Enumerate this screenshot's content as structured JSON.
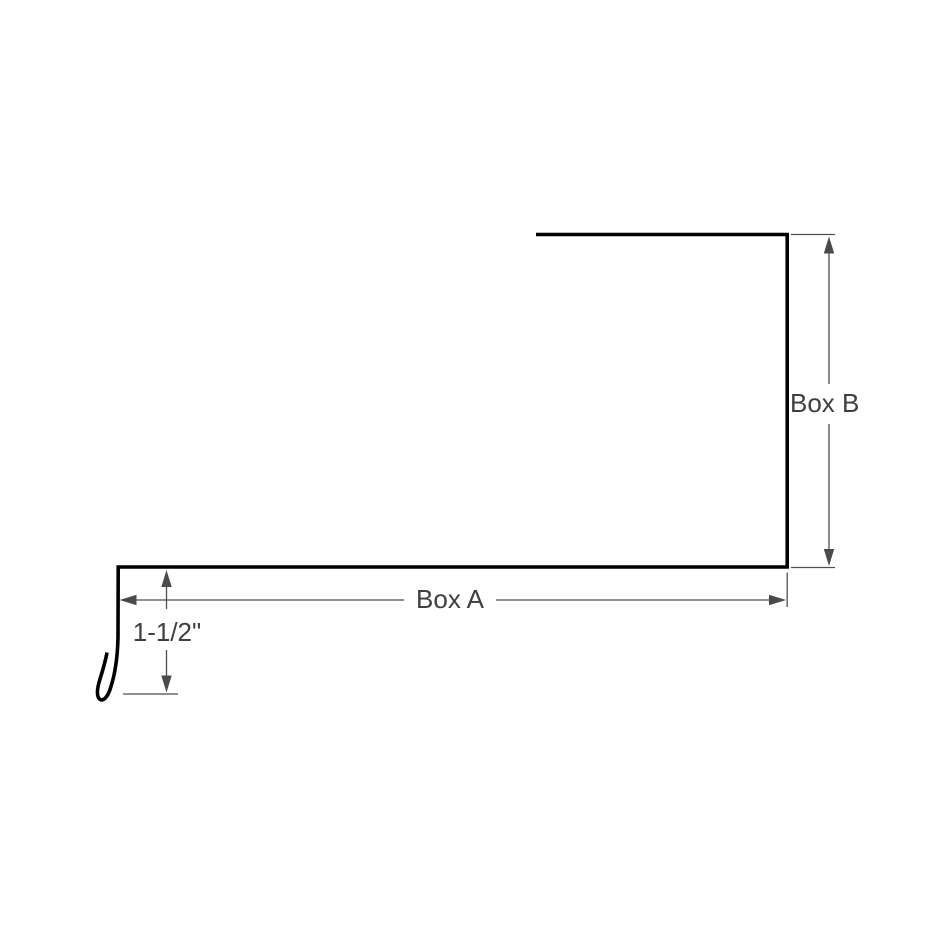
{
  "diagram": {
    "kind": "sheet-metal-trim-profile-drawing",
    "background_color": "#ffffff",
    "profile_line_color": "#000000",
    "dimension_line_color": "#4f4f4f",
    "text_color": "#3f3f3f",
    "labels": {
      "box_a": "Box A",
      "box_b": "Box B",
      "hem": "1-1/2\""
    },
    "dimensions": [
      {
        "id": "box-a",
        "label": "Box A",
        "orientation": "horizontal",
        "measures": "bottom run length"
      },
      {
        "id": "box-b",
        "label": "Box B",
        "orientation": "vertical",
        "measures": "right leg height"
      },
      {
        "id": "hem",
        "label": "1-1/2\"",
        "orientation": "vertical",
        "measures": "left drop leg with hemmed drip edge"
      }
    ]
  }
}
